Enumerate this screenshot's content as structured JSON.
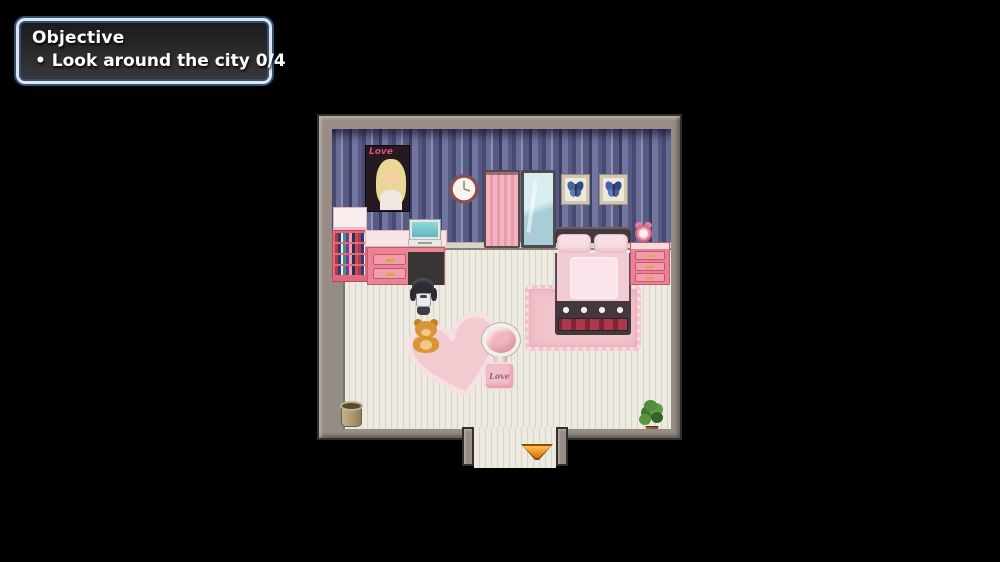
{
  "hud": {
    "objective_panel": {
      "title": "Objective",
      "items": [
        {
          "text": "• Look around the city 0/4"
        }
      ],
      "progress": "0/4",
      "colors": {
        "border_light": "#dbe6f2",
        "border_dark": "#33506e",
        "background": "#2b2b2e",
        "text": "#ffffff"
      }
    }
  },
  "scene": {
    "type": "rpg-maker-room",
    "description": "top-down pink bedroom with striped wallpaper",
    "colors": {
      "page_background": "#000000",
      "room_frame": "#978d86",
      "wallpaper_base": "#565a83",
      "floor": "#e9e6de",
      "furniture_pink": "#ea8195",
      "exit_arrow": "#f09228"
    },
    "objects": {
      "poster_title": "Love",
      "love_cushion_text": "Love",
      "icon_names": [
        "magazine-poster-icon",
        "wall-clock-icon",
        "curtain-icon",
        "mirror-icon",
        "butterfly-frame-icon",
        "bookshelf-icon",
        "desk-icon",
        "laptop-icon",
        "bed-icon",
        "nightstand-icon",
        "alarm-clock-icon",
        "heart-rug-icon",
        "rect-rug-icon",
        "round-table-icon",
        "love-cushion-icon",
        "teddy-bear-icon",
        "player-character-icon",
        "trash-can-icon",
        "potted-plant-icon",
        "exit-arrow-icon"
      ]
    }
  }
}
